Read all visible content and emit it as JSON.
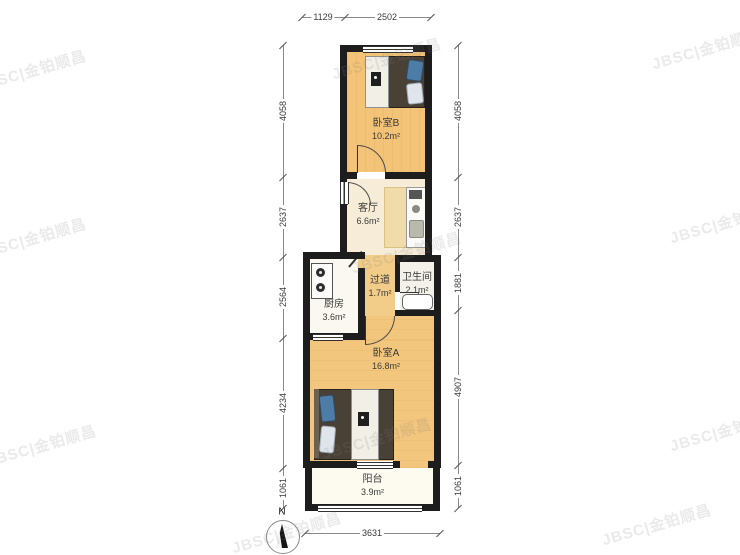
{
  "watermark": {
    "text": "JBSC|金铂顺昌"
  },
  "compass": {
    "label": "N"
  },
  "rooms": [
    {
      "id": "bedroom-b",
      "name": "卧室B",
      "area": "10.2m²"
    },
    {
      "id": "living",
      "name": "客厅",
      "area": "6.6m²"
    },
    {
      "id": "kitchen",
      "name": "厨房",
      "area": "3.6m²"
    },
    {
      "id": "corridor",
      "name": "过道",
      "area": "1.7m²"
    },
    {
      "id": "bathroom",
      "name": "卫生间",
      "area": "2.1m²"
    },
    {
      "id": "bedroom-a",
      "name": "卧室A",
      "area": "16.8m²"
    },
    {
      "id": "balcony",
      "name": "阳台",
      "area": "3.9m²"
    }
  ],
  "dimensions": {
    "top": [
      "1129",
      "2502"
    ],
    "bottom": [
      "3631"
    ],
    "left": [
      "4058",
      "2637",
      "2564",
      "4234",
      "1061"
    ],
    "right": [
      "4058",
      "2637",
      "1881",
      "4907",
      "1061"
    ]
  },
  "colors": {
    "wall": "#1d1d1d",
    "wood_floor": "#f3c377",
    "light_floor": "#f7ecd7",
    "corridor_floor": "#f2cd8a",
    "bed_dark": "#4a4136",
    "pillow_blue": "#4d7ca6"
  }
}
